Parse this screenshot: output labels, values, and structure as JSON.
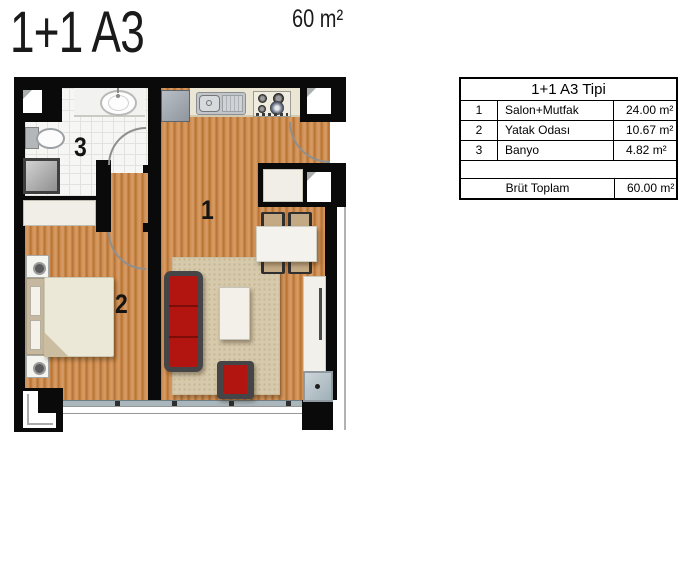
{
  "header": {
    "title": "1+1 A3",
    "area": "60 m²"
  },
  "spec_table": {
    "title": "1+1 A3 Tipi",
    "rows": [
      {
        "num": "1",
        "name": "Salon+Mutfak",
        "area": "24.00 m²"
      },
      {
        "num": "2",
        "name": "Yatak Odası",
        "area": "10.67 m²"
      },
      {
        "num": "3",
        "name": "Banyo",
        "area": "4.82 m²"
      }
    ],
    "total_label": "Brüt Toplam",
    "total_value": "60.00 m²"
  },
  "plan": {
    "room_labels": [
      {
        "id": "1",
        "room": "Salon+Mutfak"
      },
      {
        "id": "2",
        "room": "Yatak Odası"
      },
      {
        "id": "3",
        "room": "Banyo"
      }
    ],
    "colors": {
      "wall": "#0a0a0a",
      "wood": "#c98a4e",
      "accent_red": "#b2150f",
      "rug": "#d6c9ac",
      "tile": "#f6f6f4",
      "counter": "#ebe6d4"
    }
  }
}
